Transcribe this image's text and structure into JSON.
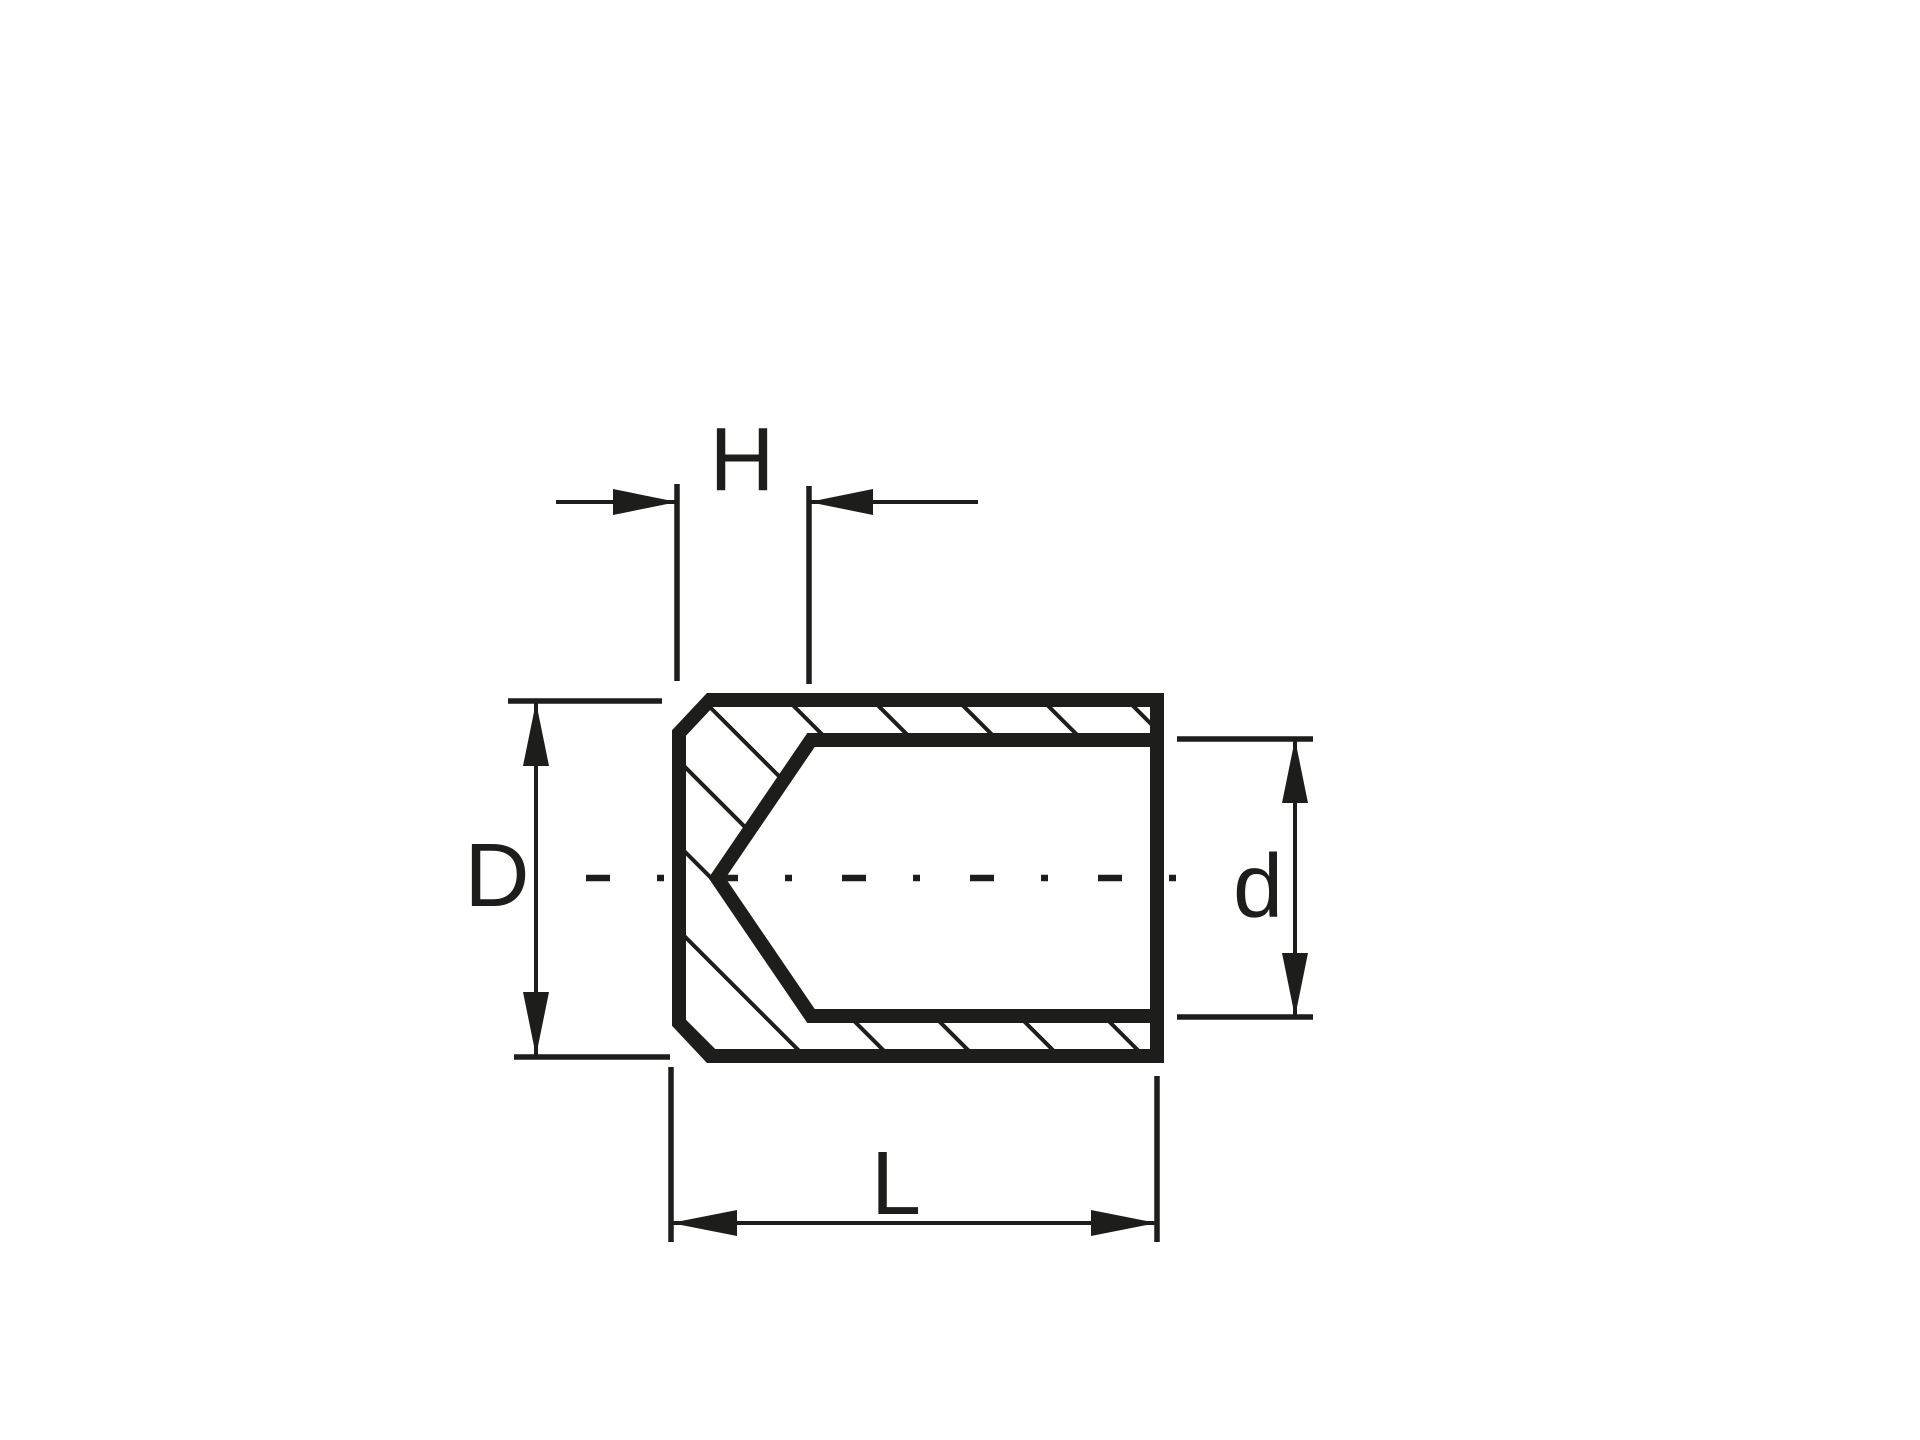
{
  "drawing": {
    "background_color": "#ffffff",
    "ink_color": "#1d1d1b",
    "dims": {
      "h": {
        "label": "H"
      },
      "outer_diameter": {
        "label": "D"
      },
      "bore_diameter": {
        "label": "d"
      },
      "length": {
        "label": "L"
      }
    }
  }
}
